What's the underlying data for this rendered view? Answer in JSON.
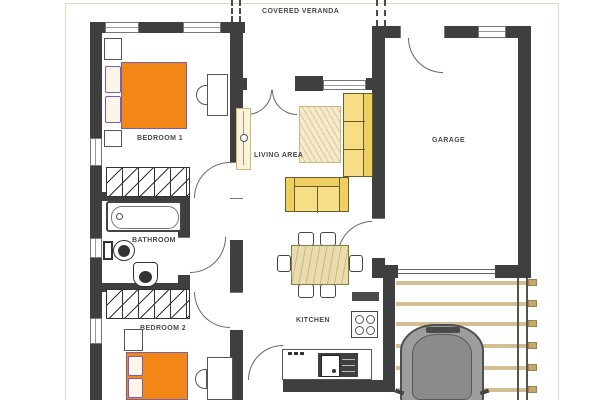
{
  "rooms": {
    "covered_veranda": {
      "label": "COVERED VERANDA"
    },
    "bedroom1": {
      "label": "BEDROOM 1"
    },
    "bathroom": {
      "label": "BATHROOM"
    },
    "bedroom2": {
      "label": "BEDROOM 2"
    },
    "living_area": {
      "label": "LIVING AREA"
    },
    "kitchen": {
      "label": "KITCHEN"
    },
    "garage": {
      "label": "GARAGE"
    }
  },
  "colors": {
    "wall": "#3f3f3f",
    "bed": "#f28718",
    "bedline": "#7a5fa8",
    "sofa": "#f7dd85",
    "sofaarm": "#f0cf62",
    "cream": "#faf3d8",
    "wood": "#e9dcae",
    "woodline": "#cdb87c",
    "beam": "#d4bf93",
    "beamend": "#c3a76c",
    "car": "#9e9e9e",
    "carroof": "#8b8b8b",
    "carline": "#4f4f4f",
    "paper": "#ded9c0",
    "label": "#4a4a4a"
  }
}
